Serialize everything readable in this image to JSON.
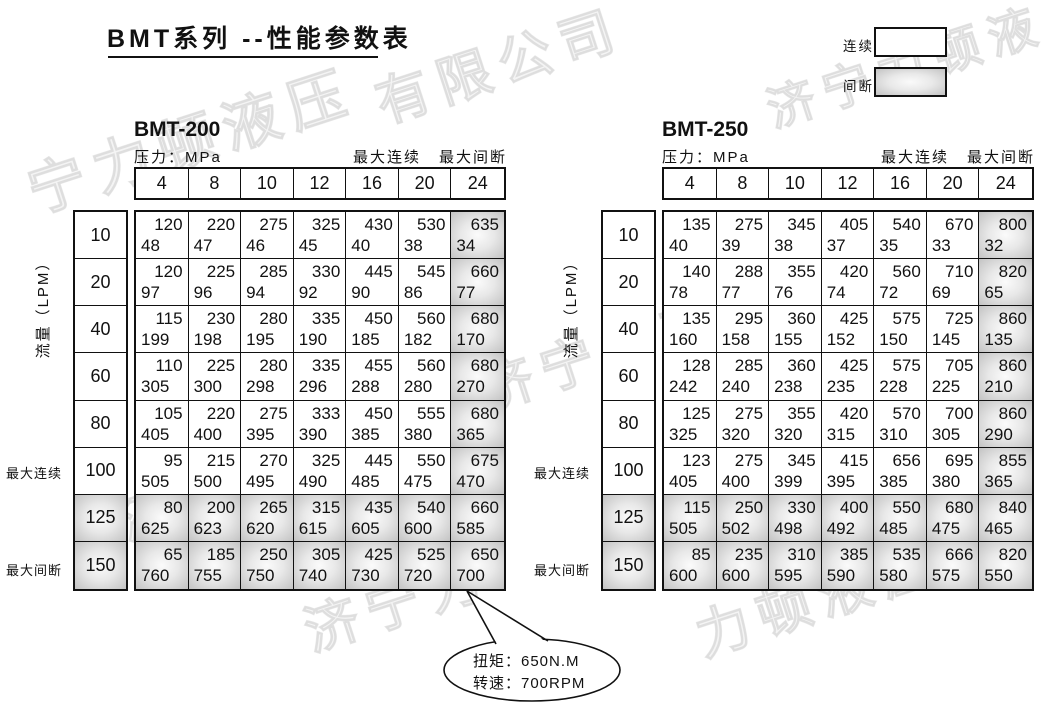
{
  "title": "BMT系列 --性能参数表",
  "legend": {
    "continuous": "连续",
    "intermittent": "间断"
  },
  "axis": {
    "flow": "流量（LPM）",
    "max_continuous": "最大连续",
    "max_intermittent": "最大间断"
  },
  "pressure_label": "压力：MPa",
  "pressures": [
    "4",
    "8",
    "10",
    "12",
    "16",
    "20",
    "24"
  ],
  "flows": [
    "10",
    "20",
    "40",
    "60",
    "80",
    "100",
    "125",
    "150"
  ],
  "tables": [
    {
      "name": "BMT-200",
      "rows": [
        [
          [
            "120",
            "48"
          ],
          [
            "220",
            "47"
          ],
          [
            "275",
            "46"
          ],
          [
            "325",
            "45"
          ],
          [
            "430",
            "40"
          ],
          [
            "530",
            "38"
          ],
          [
            "635",
            "34"
          ]
        ],
        [
          [
            "120",
            "97"
          ],
          [
            "225",
            "96"
          ],
          [
            "285",
            "94"
          ],
          [
            "330",
            "92"
          ],
          [
            "445",
            "90"
          ],
          [
            "545",
            "86"
          ],
          [
            "660",
            "77"
          ]
        ],
        [
          [
            "115",
            "199"
          ],
          [
            "230",
            "198"
          ],
          [
            "280",
            "195"
          ],
          [
            "335",
            "190"
          ],
          [
            "450",
            "185"
          ],
          [
            "560",
            "182"
          ],
          [
            "680",
            "170"
          ]
        ],
        [
          [
            "110",
            "305"
          ],
          [
            "225",
            "300"
          ],
          [
            "280",
            "298"
          ],
          [
            "335",
            "296"
          ],
          [
            "455",
            "288"
          ],
          [
            "560",
            "280"
          ],
          [
            "680",
            "270"
          ]
        ],
        [
          [
            "105",
            "405"
          ],
          [
            "220",
            "400"
          ],
          [
            "275",
            "395"
          ],
          [
            "333",
            "390"
          ],
          [
            "450",
            "385"
          ],
          [
            "555",
            "380"
          ],
          [
            "680",
            "365"
          ]
        ],
        [
          [
            "95",
            "505"
          ],
          [
            "215",
            "500"
          ],
          [
            "270",
            "495"
          ],
          [
            "325",
            "490"
          ],
          [
            "445",
            "485"
          ],
          [
            "550",
            "475"
          ],
          [
            "675",
            "470"
          ]
        ],
        [
          [
            "80",
            "625"
          ],
          [
            "200",
            "623"
          ],
          [
            "265",
            "620"
          ],
          [
            "315",
            "615"
          ],
          [
            "435",
            "605"
          ],
          [
            "540",
            "600"
          ],
          [
            "660",
            "585"
          ]
        ],
        [
          [
            "65",
            "760"
          ],
          [
            "185",
            "755"
          ],
          [
            "250",
            "750"
          ],
          [
            "305",
            "740"
          ],
          [
            "425",
            "730"
          ],
          [
            "525",
            "720"
          ],
          [
            "650",
            "700"
          ]
        ]
      ]
    },
    {
      "name": "BMT-250",
      "rows": [
        [
          [
            "135",
            "40"
          ],
          [
            "275",
            "39"
          ],
          [
            "345",
            "38"
          ],
          [
            "405",
            "37"
          ],
          [
            "540",
            "35"
          ],
          [
            "670",
            "33"
          ],
          [
            "800",
            "32"
          ]
        ],
        [
          [
            "140",
            "78"
          ],
          [
            "288",
            "77"
          ],
          [
            "355",
            "76"
          ],
          [
            "420",
            "74"
          ],
          [
            "560",
            "72"
          ],
          [
            "710",
            "69"
          ],
          [
            "820",
            "65"
          ]
        ],
        [
          [
            "135",
            "160"
          ],
          [
            "295",
            "158"
          ],
          [
            "360",
            "155"
          ],
          [
            "425",
            "152"
          ],
          [
            "575",
            "150"
          ],
          [
            "725",
            "145"
          ],
          [
            "860",
            "135"
          ]
        ],
        [
          [
            "128",
            "242"
          ],
          [
            "285",
            "240"
          ],
          [
            "360",
            "238"
          ],
          [
            "425",
            "235"
          ],
          [
            "575",
            "228"
          ],
          [
            "705",
            "225"
          ],
          [
            "860",
            "210"
          ]
        ],
        [
          [
            "125",
            "325"
          ],
          [
            "275",
            "320"
          ],
          [
            "355",
            "320"
          ],
          [
            "420",
            "315"
          ],
          [
            "570",
            "310"
          ],
          [
            "700",
            "305"
          ],
          [
            "860",
            "290"
          ]
        ],
        [
          [
            "123",
            "405"
          ],
          [
            "275",
            "400"
          ],
          [
            "345",
            "399"
          ],
          [
            "415",
            "395"
          ],
          [
            "656",
            "385"
          ],
          [
            "695",
            "380"
          ],
          [
            "855",
            "365"
          ]
        ],
        [
          [
            "115",
            "505"
          ],
          [
            "250",
            "502"
          ],
          [
            "330",
            "498"
          ],
          [
            "400",
            "492"
          ],
          [
            "550",
            "485"
          ],
          [
            "680",
            "475"
          ],
          [
            "840",
            "465"
          ]
        ],
        [
          [
            "85",
            "600"
          ],
          [
            "235",
            "600"
          ],
          [
            "310",
            "595"
          ],
          [
            "385",
            "590"
          ],
          [
            "535",
            "580"
          ],
          [
            "666",
            "575"
          ],
          [
            "820",
            "550"
          ]
        ]
      ]
    }
  ],
  "callout": {
    "torque": "扭矩：650N.M",
    "speed": "转速：700RPM"
  },
  "watermarks": [
    "宁力顿液压",
    "有限公司",
    "济宁力顿液",
    "济宁力顿液压",
    "液压有限公司",
    "济宁力",
    "力顿液压"
  ]
}
